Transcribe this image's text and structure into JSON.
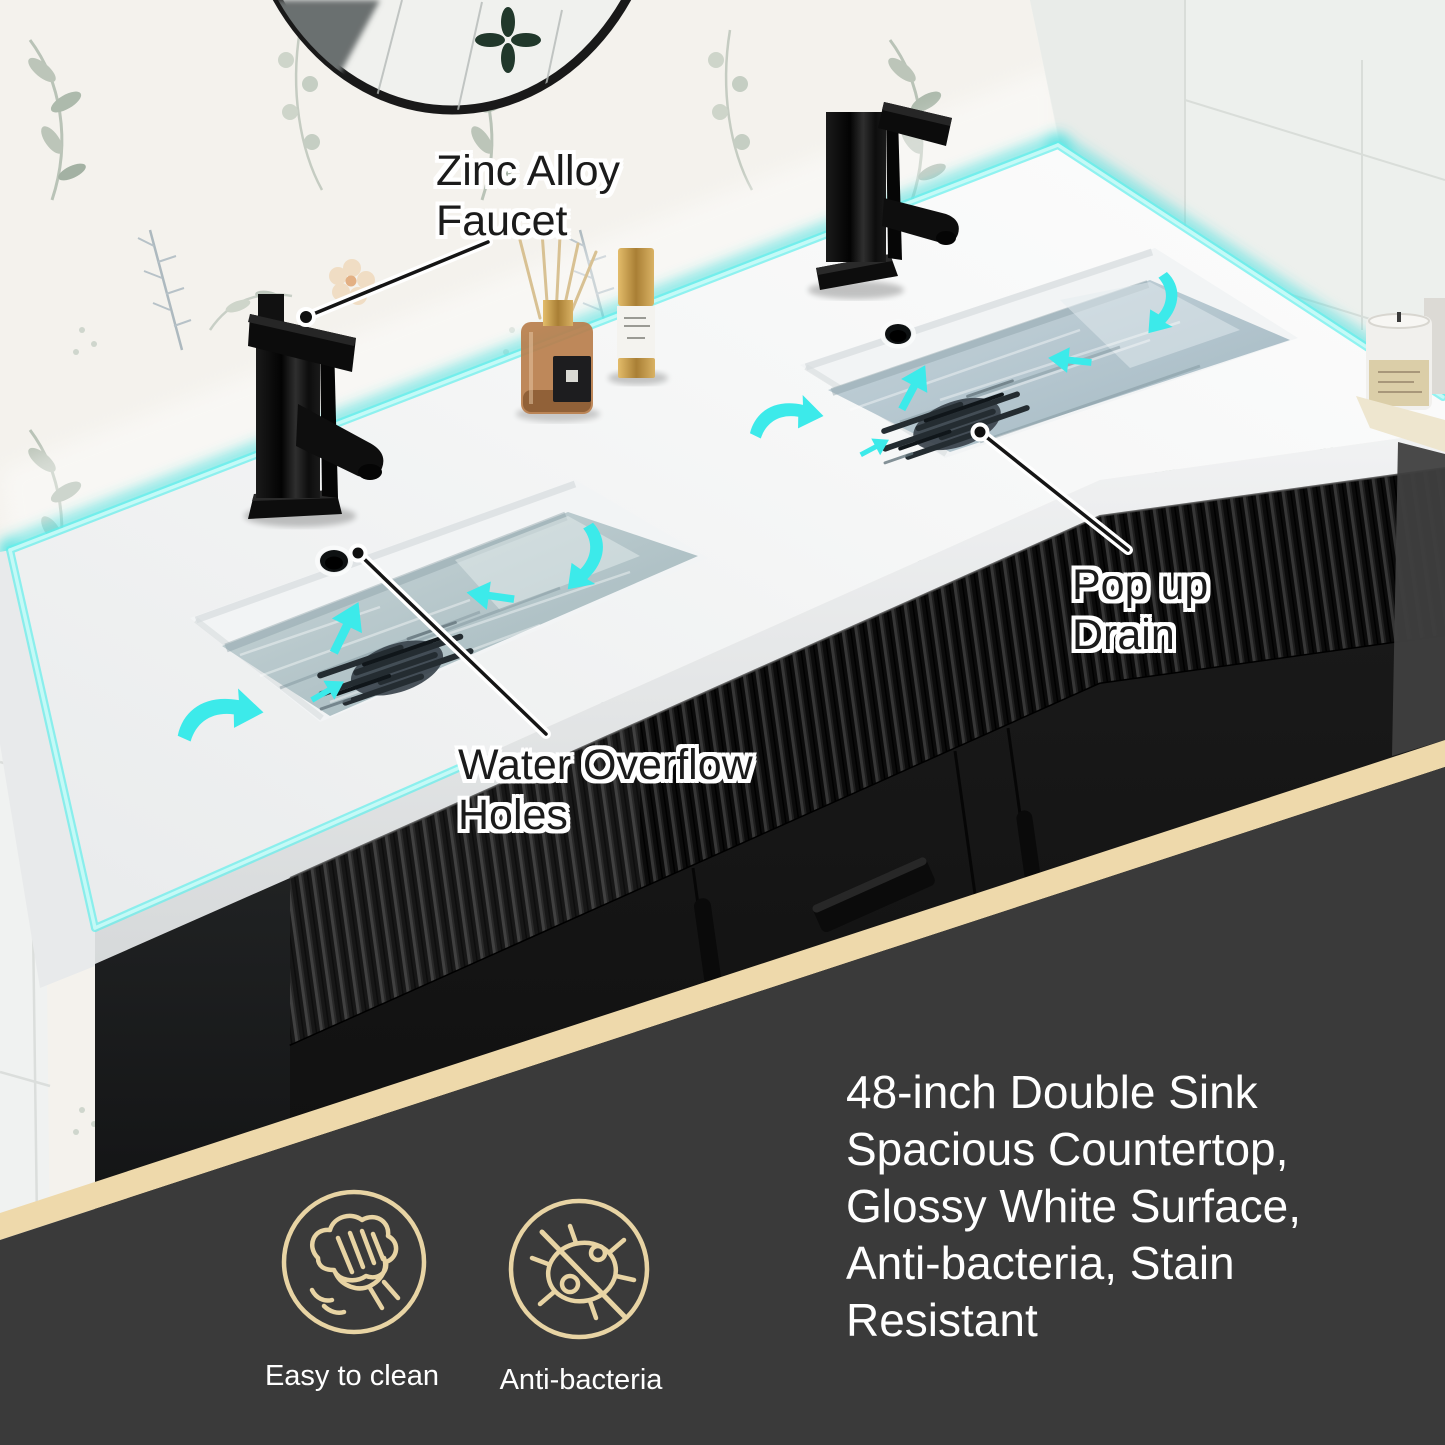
{
  "image_type": "product-feature-graphic",
  "photo": {
    "annotations": {
      "faucet": {
        "line1": "Zinc Alloy",
        "line2": "Faucet"
      },
      "overflow": {
        "line1": "Water Overflow",
        "line2": "Holes"
      },
      "drain": {
        "line1": "Pop up",
        "line2": "Drain"
      }
    }
  },
  "info_panel": {
    "description": {
      "lines": [
        "48-inch Double Sink",
        "Spacious Countertop,",
        "Glossy White Surface,",
        "Anti-bacteria, Stain",
        "Resistant"
      ],
      "full_text": "48-inch Double Sink Spacious Countertop, Glossy White Surface, Anti-bacteria, Stain Resistant"
    },
    "features": [
      {
        "icon": "easy-to-clean-icon",
        "label": "Easy to clean"
      },
      {
        "icon": "anti-bacteria-icon",
        "label": "Anti-bacteria"
      }
    ]
  },
  "colors": {
    "accent_cyan": "#3ee6e4",
    "divider_tan": "#eed9ab",
    "panel_dark": "#3a3a3a",
    "icon_outline_tan": "#e8d4a4",
    "annotation_text": "#1b1b1b",
    "description_text": "#ffffff"
  }
}
